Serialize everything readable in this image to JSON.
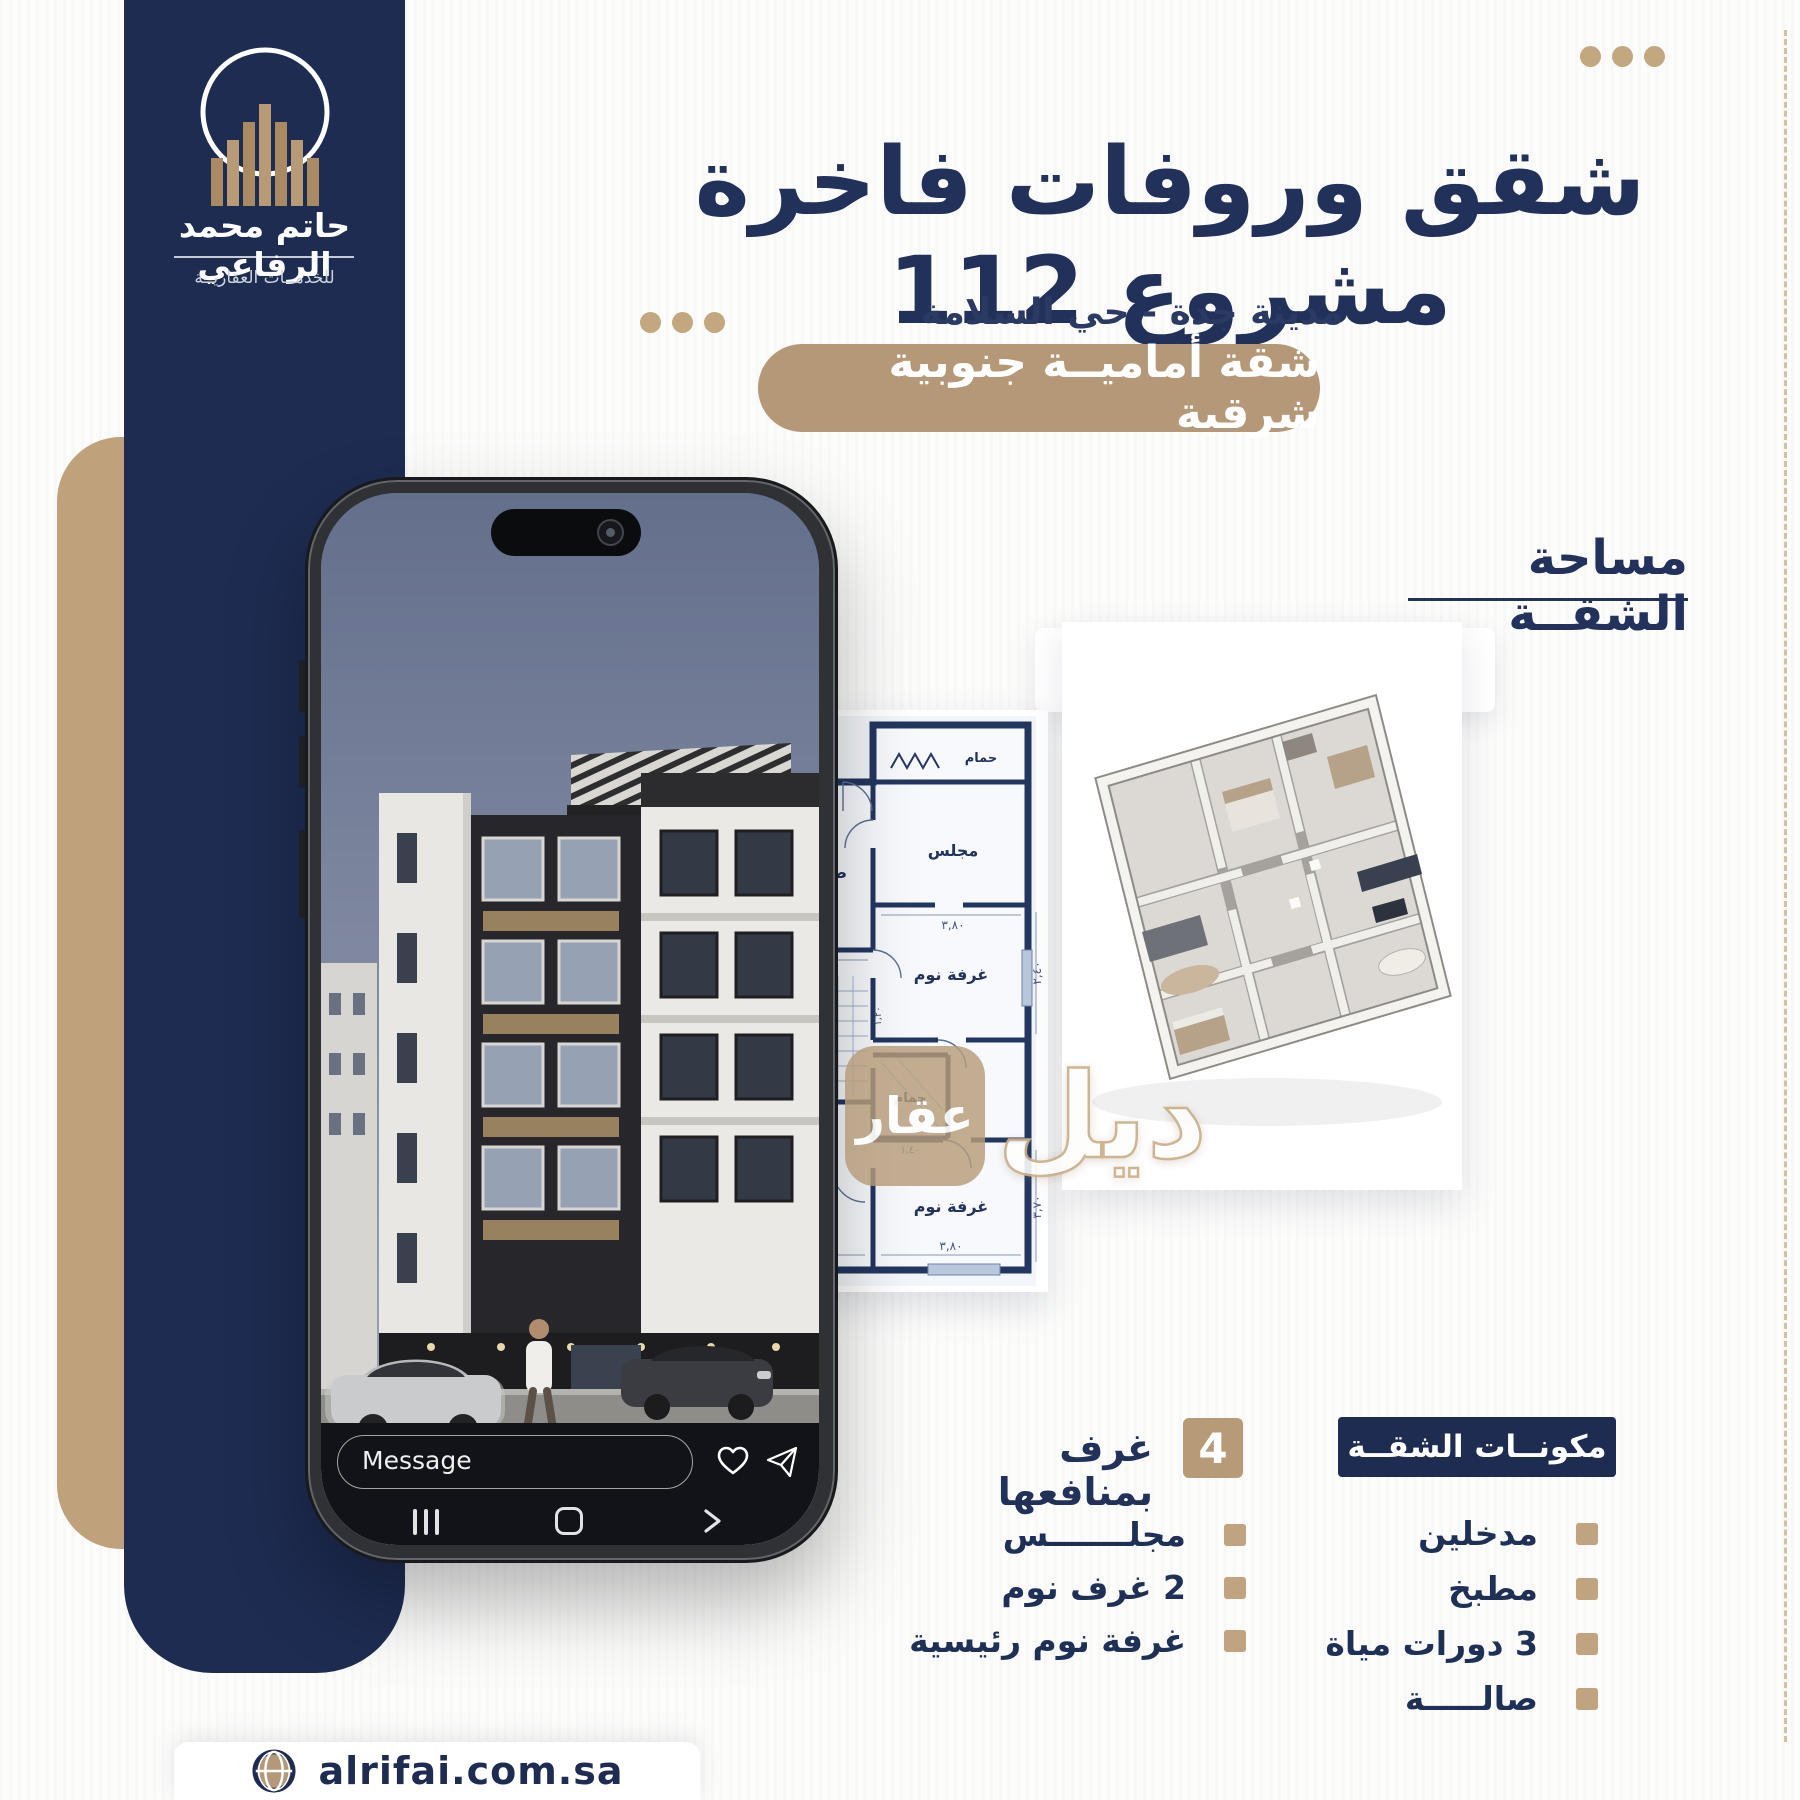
{
  "colors": {
    "navy": "#1e2c52",
    "tan": "#b49877"
  },
  "sidebar": {
    "name": "حاتم محمد الرفاعي",
    "tagline": "للخدمــات العقاريــة"
  },
  "header": {
    "title": "شقق وروفات فاخرة مشروع 112",
    "subtitle": "مدينة جدة - حي السلامة",
    "banner": "شقة أماميــة جنوبية شرقية"
  },
  "area": {
    "label": "مساحة الشقــة",
    "value": "124,42",
    "unit": "متــر"
  },
  "phone": {
    "message_placeholder": "Message"
  },
  "plan": {
    "rooms": {
      "bath_top": "حمام",
      "majlis": "مجلس",
      "living": "صالة معيشة",
      "kitchen": "مطبخ",
      "bath_left": "حمام",
      "bath_mid": "حمام",
      "bed_mid": "غرفة نوم",
      "master_1": "غرفة نوم",
      "master_2": "ماستر",
      "bed_right": "غرفة نوم"
    },
    "dims": {
      "majlis_w": "٣,٨٠",
      "living_h": "٣,٧٠",
      "living_w": "٤,٧٠",
      "kitchen_h": "٣,١٠",
      "kitchen_w": "٣,٣٠",
      "hall_w": "١,٢٠",
      "hall_h": "١,٤٠",
      "bed_mid_h": "٢,٤٠",
      "master_w": "٤,٧٠",
      "bed_right_w": "٣,٨٠",
      "bed_right_h": "٣,٧٠"
    }
  },
  "watermark": {
    "box": "عقار",
    "word": "ديل"
  },
  "units_section": {
    "count": "4",
    "label": "غرف بمنافعها",
    "items": [
      "مجلـــــــس",
      "2 غرف نوم",
      "غرفة نوم رئيسية"
    ]
  },
  "components_section": {
    "title": "مكونــات الشقــة",
    "items": [
      "مدخلين",
      "مطبخ",
      "3 دورات مياة",
      "صالـــــة"
    ]
  },
  "footer": {
    "website": "alrifai.com.sa"
  }
}
